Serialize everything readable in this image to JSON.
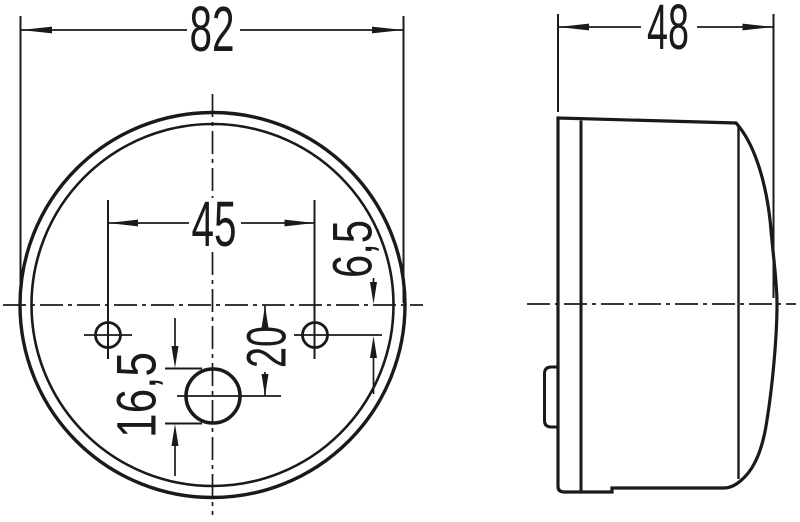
{
  "colors": {
    "background": "#ffffff",
    "line": "#1a1a1a"
  },
  "dimensions": {
    "outer_diameter": "82",
    "mounting_hole_spacing": "45",
    "mounting_hole_offset": "6,5",
    "center_hole_offset": "20",
    "center_hole_size": "16,5",
    "depth": "48"
  }
}
